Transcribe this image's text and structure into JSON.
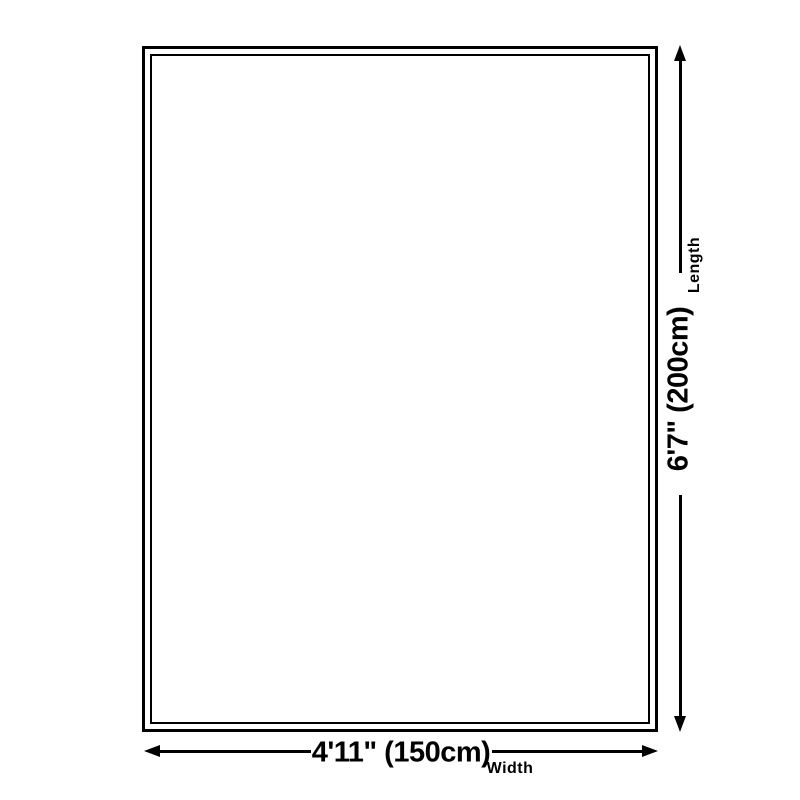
{
  "diagram": {
    "title": "product-size-diagram",
    "length": {
      "value": "6'7\" (200cm)",
      "axis_label": "Length"
    },
    "width": {
      "value": "4'11\" (150cm)",
      "axis_label": "Width"
    }
  },
  "colors": {
    "background": "#ffffff",
    "outline": "#000000",
    "text": "#000000"
  }
}
